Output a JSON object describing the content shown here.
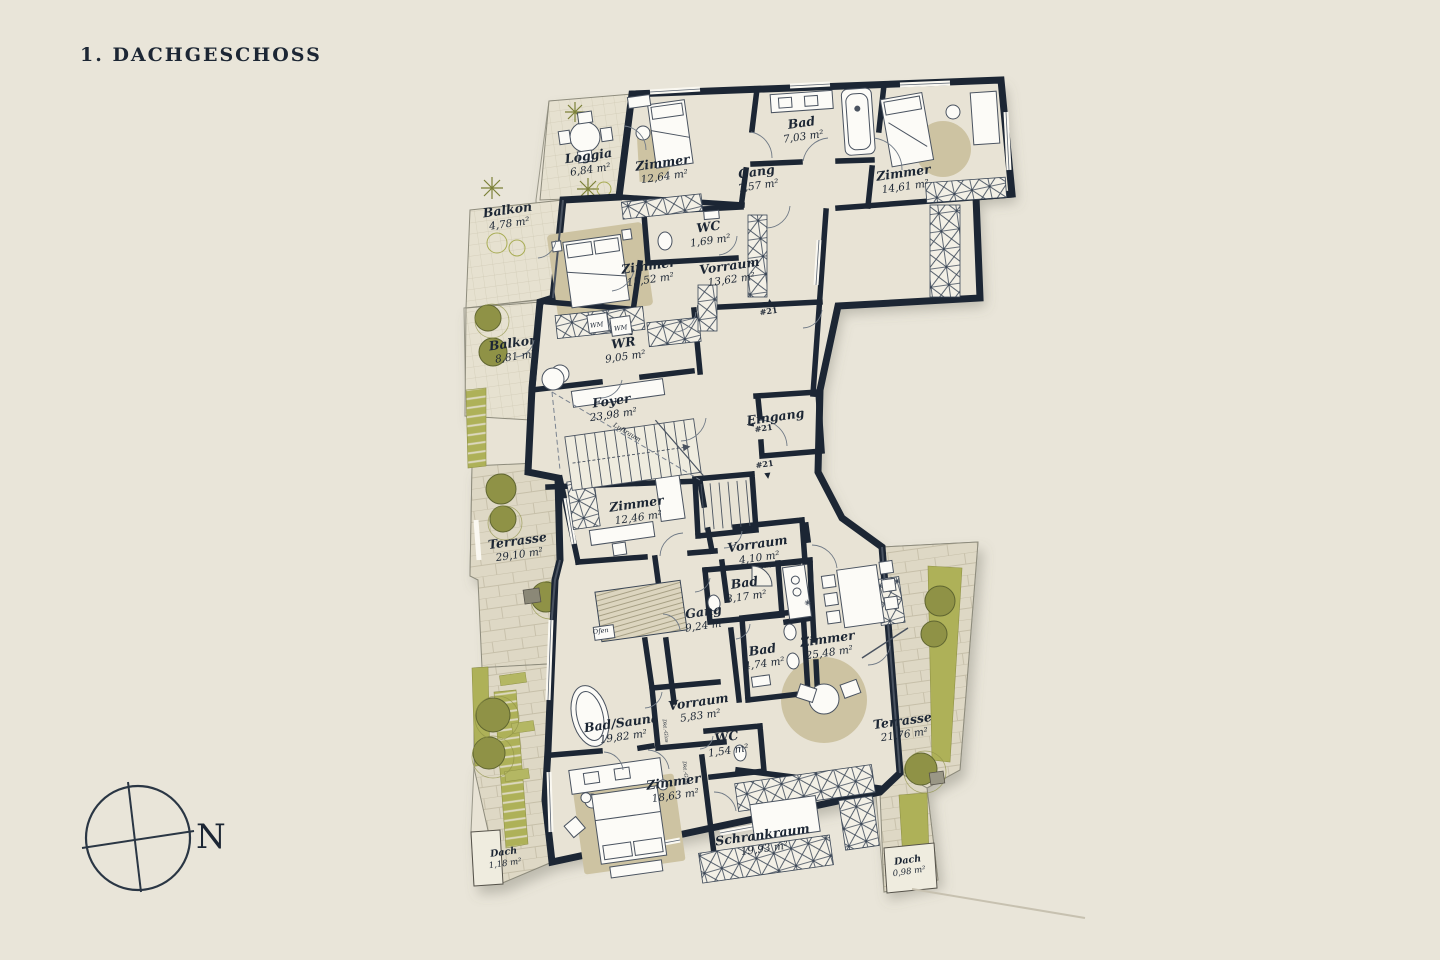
{
  "title": "1. DACHGESCHOSS",
  "compass": {
    "north_label": "N"
  },
  "colors": {
    "background": "#e9e5d9",
    "wall": "#1c2634",
    "room_fill": "#e8e3d5",
    "terrace_fill": "#ded8c5",
    "rug": "#cdc3a2",
    "olive": "#8f9246",
    "olive_strip": "#aeb158",
    "light_green": "#c9cd7e",
    "label": "#1c2634"
  },
  "floorplan": {
    "rooms": [
      {
        "name": "Loggia",
        "area": "6,84 m²",
        "x": 589,
        "y": 160
      },
      {
        "name": "Zimmer",
        "area": "12,64 m²",
        "x": 663,
        "y": 167
      },
      {
        "name": "Bad",
        "area": "7,03 m²",
        "x": 802,
        "y": 127
      },
      {
        "name": "Gang",
        "area": "7,57 m²",
        "x": 757,
        "y": 176
      },
      {
        "name": "Zimmer",
        "area": "14,61 m²",
        "x": 904,
        "y": 177
      },
      {
        "name": "WC",
        "area": "1,69 m²",
        "x": 709,
        "y": 231
      },
      {
        "name": "Vorraum",
        "area": "13,62 m²",
        "x": 730,
        "y": 270
      },
      {
        "name": "Balkon",
        "area": "4,78 m²",
        "x": 508,
        "y": 214
      },
      {
        "name": "Zimmer",
        "area": "15,52 m²",
        "x": 649,
        "y": 270
      },
      {
        "name": "Balkon",
        "area": "8,81 m²",
        "x": 514,
        "y": 347
      },
      {
        "name": "WR",
        "area": "9,05 m²",
        "x": 624,
        "y": 347
      },
      {
        "name": "Foyer",
        "area": "23,98 m²",
        "x": 612,
        "y": 405
      },
      {
        "name": "Zimmer",
        "area": "12,46 m²",
        "x": 637,
        "y": 508
      },
      {
        "name": "Terrasse",
        "area": "29,10 m²",
        "x": 518,
        "y": 545
      },
      {
        "name": "Vorraum",
        "area": "4,10 m²",
        "x": 758,
        "y": 548
      },
      {
        "name": "Bad",
        "area": "3,17 m²",
        "x": 745,
        "y": 587
      },
      {
        "name": "Gang",
        "area": "9,24 m²",
        "x": 704,
        "y": 616
      },
      {
        "name": "Bad",
        "area": "4,74 m²",
        "x": 763,
        "y": 654
      },
      {
        "name": "Zimmer",
        "area": "25,48 m²",
        "x": 828,
        "y": 643
      },
      {
        "name": "Terrasse",
        "area": "21,76 m²",
        "x": 903,
        "y": 725
      },
      {
        "name": "Vorraum",
        "area": "5,83 m²",
        "x": 699,
        "y": 706
      },
      {
        "name": "WC",
        "area": "1,54 m²",
        "x": 727,
        "y": 741
      },
      {
        "name": "Bad/Sauna",
        "area": "19,82 m²",
        "x": 622,
        "y": 727
      },
      {
        "name": "Zimmer",
        "area": "18,63 m²",
        "x": 674,
        "y": 786
      },
      {
        "name": "Schrankraum",
        "area": "19,93 m²",
        "x": 763,
        "y": 839
      },
      {
        "name": "Dach",
        "area": "1,18 m²",
        "x": 504,
        "y": 855,
        "small": true
      },
      {
        "name": "Dach",
        "area": "0,98 m²",
        "x": 908,
        "y": 863,
        "small": true
      }
    ],
    "annotations": [
      {
        "text": "Eingang",
        "x": 776,
        "y": 421,
        "rot": -8,
        "cls": "rname"
      },
      {
        "text": "#21",
        "x": 764,
        "y": 431,
        "rot": -8,
        "cls": "marker"
      },
      {
        "text": "◄",
        "x": 751,
        "y": 427,
        "rot": -8,
        "cls": "marker"
      },
      {
        "text": "▲",
        "x": 770,
        "y": 304,
        "rot": -8,
        "cls": "marker"
      },
      {
        "text": "#21",
        "x": 769,
        "y": 314,
        "rot": -8,
        "cls": "marker"
      },
      {
        "text": "#21",
        "x": 765,
        "y": 467,
        "rot": -8,
        "cls": "marker"
      },
      {
        "text": "▼",
        "x": 768,
        "y": 478,
        "rot": -8,
        "cls": "marker"
      },
      {
        "text": "WM",
        "x": 597,
        "y": 327,
        "rot": -8,
        "cls": "tiny"
      },
      {
        "text": "WM",
        "x": 621,
        "y": 330,
        "rot": -8,
        "cls": "tiny"
      },
      {
        "text": "Ofen",
        "x": 601,
        "y": 633,
        "rot": -8,
        "cls": "tiny"
      },
      {
        "text": "Luftraum",
        "x": 626,
        "y": 434,
        "rot": 31,
        "cls": "tiny"
      },
      {
        "text": "Verteiler",
        "x": 772,
        "y": 567,
        "rot": -8,
        "cls": "tiny4"
      },
      {
        "text": "Dkt.-Glas",
        "x": 664,
        "y": 731,
        "rot": 83,
        "cls": "tiny4"
      },
      {
        "text": "Dkt.-Glas",
        "x": 684,
        "y": 773,
        "rot": 83,
        "cls": "tiny4"
      }
    ]
  }
}
